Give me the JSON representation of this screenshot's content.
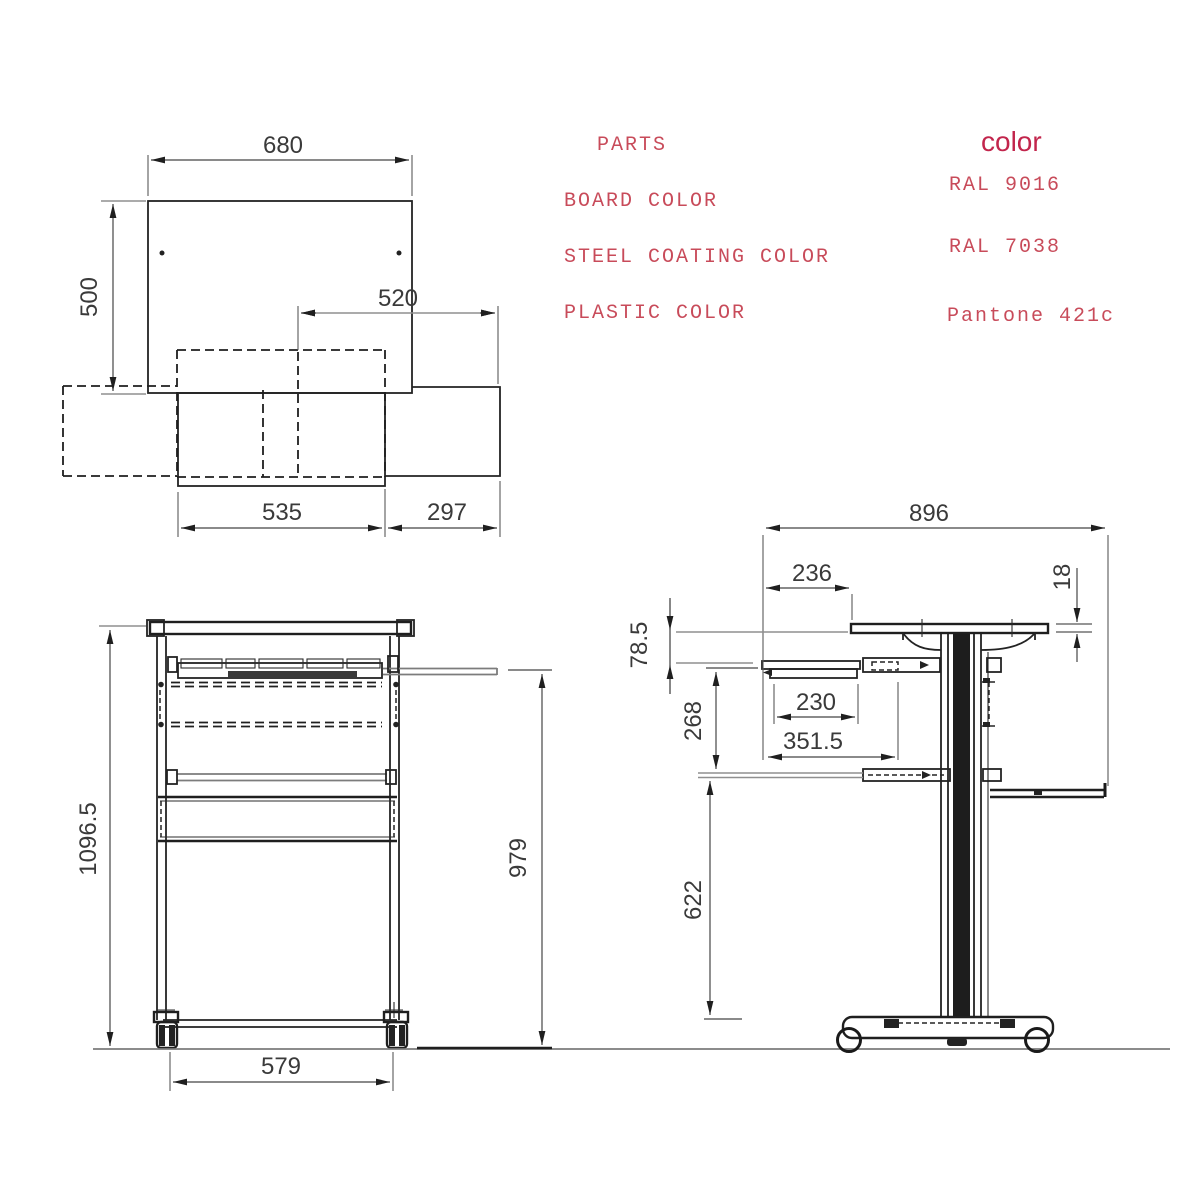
{
  "drawing_title": "mobile computer desk technical drawing",
  "table": {
    "parts_header": "PARTS",
    "color_header": "color",
    "rows": [
      {
        "part": "BOARD COLOR",
        "value": "RAL 9016"
      },
      {
        "part": "STEEL COATING COLOR",
        "value": "RAL 7038"
      },
      {
        "part": "PLASTIC COLOR",
        "value": "Pantone 421c"
      }
    ]
  },
  "dimensions": {
    "top_view": {
      "board_width": "680",
      "board_depth": "500",
      "tray_span": "520",
      "shelf_width": "535",
      "tray_extension": "297"
    },
    "front_view": {
      "overall_height": "1096.5",
      "tray_surface_height": "979",
      "base_width": "579"
    },
    "side_view": {
      "overall_depth": "896",
      "top_front_overhang": "236",
      "board_thickness": "18",
      "board_to_tray_gap": "78.5",
      "tray_to_shelf": "268",
      "tray_depth": "230",
      "rail_length": "351.5",
      "shelf_to_base": "622"
    }
  },
  "palette": {
    "background": "#ffffff",
    "line_black": "#232323",
    "line_gray": "#8f8f8f",
    "dim_text": "#3a3a3a",
    "annotation_red": "#c84b5a",
    "header_red": "#c2254c"
  }
}
